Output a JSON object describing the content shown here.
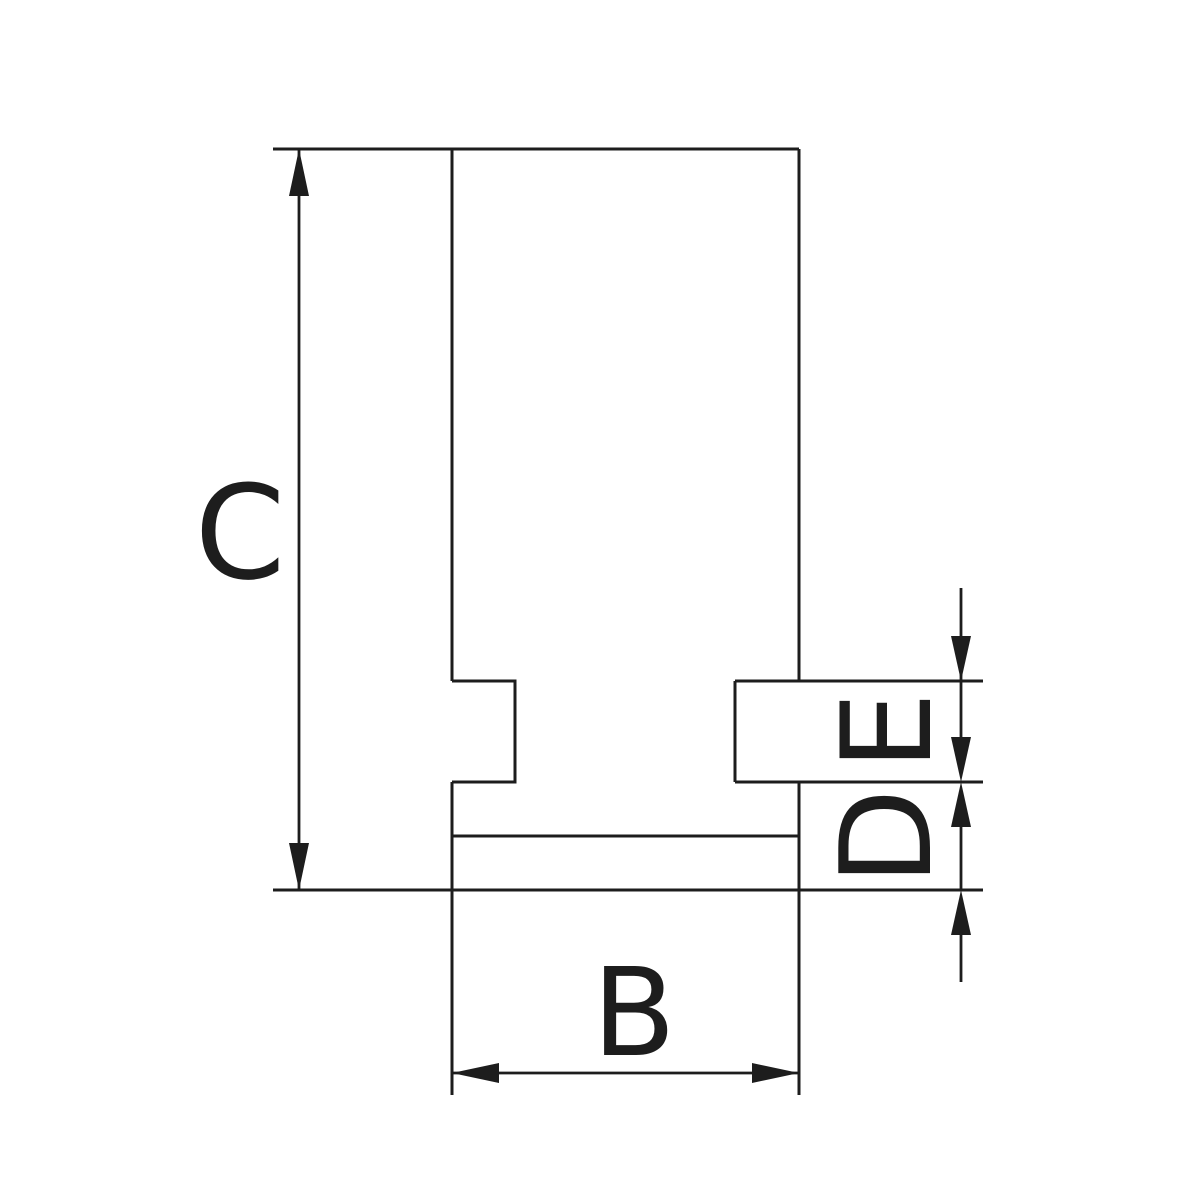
{
  "page": {
    "background": "#ffffff"
  },
  "drawing": {
    "type": "engineering-cross-section-diagram",
    "line_color": "#1d1d1d",
    "labels": {
      "overall_height": "C",
      "jaw_width": "B",
      "tenon_height": "E",
      "base_step_height": "D"
    }
  }
}
